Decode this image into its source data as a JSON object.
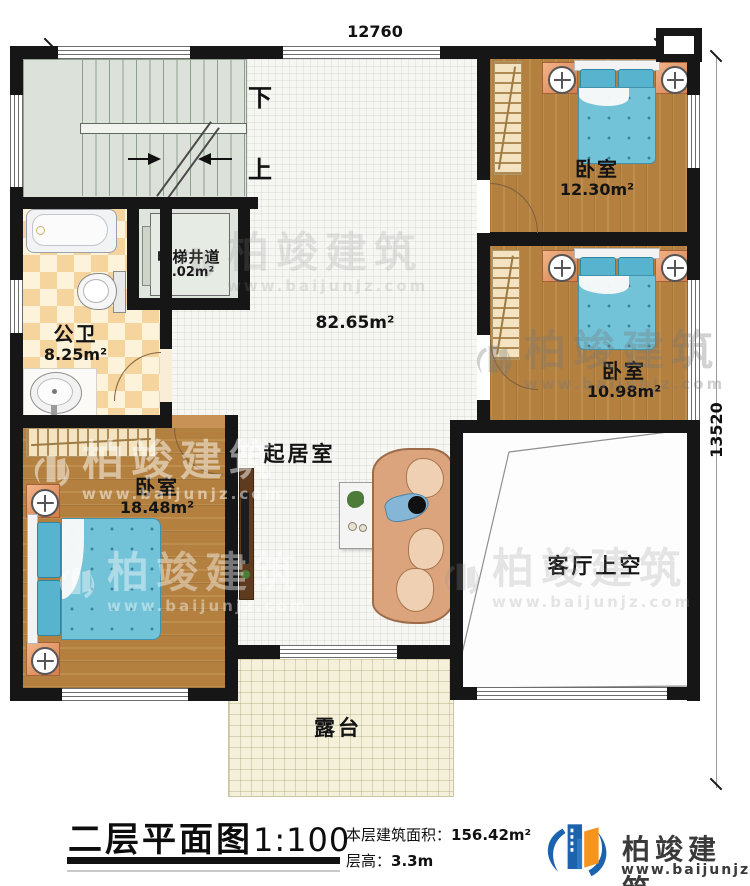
{
  "dimensions": {
    "top": "12760",
    "right": "13520"
  },
  "stairs": {
    "down": "下",
    "up": "上"
  },
  "rooms": {
    "elevator": {
      "name": "电梯井道",
      "area": "3.02m²"
    },
    "bathroom": {
      "name": "公卫",
      "area": "8.25m²"
    },
    "living": {
      "name": "起居室",
      "area": "82.65m²"
    },
    "bedroom_tr": {
      "name": "卧室",
      "area": "12.30m²"
    },
    "bedroom_mr": {
      "name": "卧室",
      "area": "10.98m²"
    },
    "bedroom_bl": {
      "name": "卧室",
      "area": "18.48m²"
    },
    "void": {
      "name": "客厅上空"
    },
    "terrace": {
      "name": "露台"
    }
  },
  "title_block": {
    "title": "二层平面图",
    "scale": "1:100",
    "area_label": "本层建筑面积：",
    "area_value": "156.42m²",
    "height_label": "层高：",
    "height_value": "3.3m"
  },
  "brand": {
    "name": "柏竣建筑",
    "website": "www.baijunjz.com"
  },
  "watermark": {
    "name": "柏竣建筑",
    "website": "www.baijunjz.com"
  }
}
